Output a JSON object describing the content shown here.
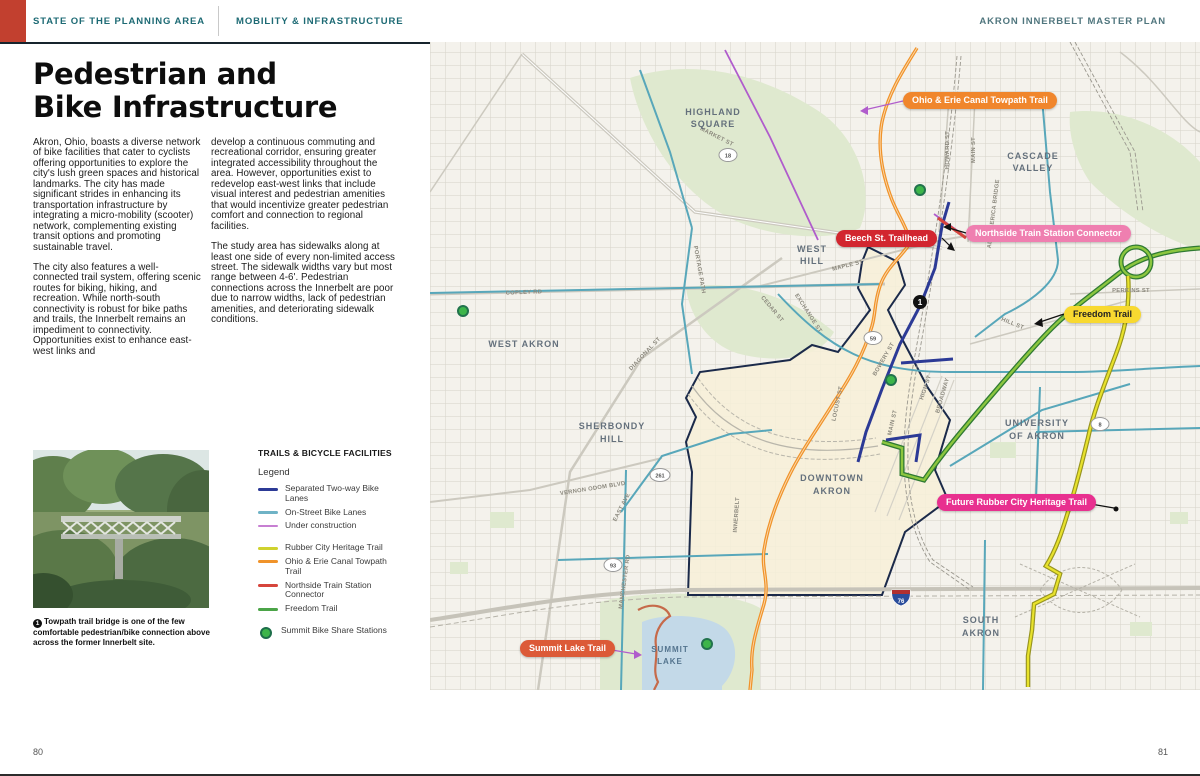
{
  "header": {
    "section": "STATE OF THE PLANNING AREA",
    "chapter": "MOBILITY & INFRASTRUCTURE",
    "document_title": "AKRON INNERBELT MASTER PLAN"
  },
  "page_numbers": {
    "left": "80",
    "right": "81"
  },
  "article": {
    "title_line1": "Pedestrian and",
    "title_line2": "Bike Infrastructure",
    "col1_para1": "Akron, Ohio, boasts a diverse network of bike facilities that cater to cyclists offering opportunities to explore the city's lush green spaces and historical landmarks. The city has made significant strides in enhancing its transportation infrastructure by integrating a micro-mobility (scooter) network, complementing existing transit options and promoting sustainable travel.",
    "col1_para2": "The city also features a well-connected trail system, offering scenic routes for biking, hiking, and recreation. While north-south connectivity is robust for bike paths and trails, the Innerbelt remains an impediment to connectivity. Opportunities exist to enhance east-west links and",
    "col2_para1": "develop a continuous commuting and recreational corridor, ensuring greater integrated accessibility throughout the area. However, opportunities exist to redevelop east-west links that include visual interest and pedestrian amenities that would incentivize greater pedestrian comfort and connection to regional facilities.",
    "col2_para2": "The study area has sidewalks along at least one side of every non-limited access street. The sidewalk widths vary but most range between 4-6'. Pedestrian connections across the Innerbelt are poor due to narrow widths, lack of pedestrian amenities, and deteriorating sidewalk conditions."
  },
  "figure": {
    "caption_marker": "1",
    "caption": "Towpath trail bridge is one of the few comfortable pedestrian/bike connection above across the former Innerbelt site."
  },
  "legend": {
    "title": "TRAILS & BICYCLE FACILITIES",
    "subtitle": "Legend",
    "items": [
      {
        "label": "Separated Two-way Bike Lanes",
        "color": "#2c3a96"
      },
      {
        "label": "On-Street Bike Lanes",
        "color": "#6fb3c6"
      },
      {
        "label": "Under construction",
        "color": "#c77fd2"
      },
      {
        "label": "Rubber City Heritage Trail",
        "color": "#cfd22e"
      },
      {
        "label": "Ohio & Erie Canal Towpath Trail",
        "color": "#f0932a"
      },
      {
        "label": "Northside Train Station Connector",
        "color": "#d6453c"
      },
      {
        "label": "Freedom Trail",
        "color": "#4ba448"
      },
      {
        "label": "Summit Bike Share Stations",
        "color": "#3db54a"
      }
    ]
  },
  "map": {
    "areas": [
      {
        "lines": [
          "HIGHLAND",
          "SQUARE"
        ]
      },
      {
        "lines": [
          "CASCADE",
          "VALLEY"
        ]
      },
      {
        "lines": [
          "WEST",
          "HILL"
        ]
      },
      {
        "lines": [
          "WEST AKRON"
        ]
      },
      {
        "lines": [
          "SHERBONDY",
          "HILL"
        ]
      },
      {
        "lines": [
          "DOWNTOWN",
          "AKRON"
        ]
      },
      {
        "lines": [
          "UNIVERSITY",
          "OF AKRON"
        ]
      },
      {
        "lines": [
          "SOUTH",
          "AKRON"
        ]
      },
      {
        "lines": [
          "SUMMIT",
          "LAKE"
        ]
      }
    ],
    "streets": [
      "MARKET ST",
      "HOWARD ST",
      "MAIN ST",
      "ALL-AMERICA BRIDGE",
      "PERKINS ST",
      "HILL ST",
      "MAPLE ST",
      "PORTAGE PATH",
      "CEDAR ST",
      "EXCHANGE ST",
      "COPLEY RD",
      "DIAGONAL ST",
      "LOCUST ST",
      "BOWERY ST",
      "HIGH ST",
      "BROADWAY",
      "MAIN ST",
      "VERNON ODOM BLVD",
      "EAST AVE",
      "MANCHESTER RD",
      "INNERBELT"
    ],
    "route_shields": [
      "18",
      "59",
      "8",
      "261",
      "93",
      "76"
    ],
    "marker_label": "1",
    "callouts": [
      {
        "label": "Ohio & Erie Canal Towpath Trail",
        "bg": "#f0862c",
        "fg": "#ffffff"
      },
      {
        "label": "Beech St. Trailhead",
        "bg": "#d2262f",
        "fg": "#ffffff"
      },
      {
        "label": "Northside Train Station Connector",
        "bg": "#ef7fb0",
        "fg": "#ffffff"
      },
      {
        "label": "Freedom Trail",
        "bg": "#f8d930",
        "fg": "#222222"
      },
      {
        "label": "Future Rubber City Heritage Trail",
        "bg": "#e8308f",
        "fg": "#ffffff"
      },
      {
        "label": "Summit Lake Trail",
        "bg": "#dc5a38",
        "fg": "#ffffff"
      }
    ]
  },
  "colors": {
    "accent_red": "#c2402f",
    "header_teal": "#1d6a74",
    "rule_dark": "#16242d",
    "study_area_fill": "#f7f0d8",
    "study_area_outline": "#1b2a4a"
  }
}
